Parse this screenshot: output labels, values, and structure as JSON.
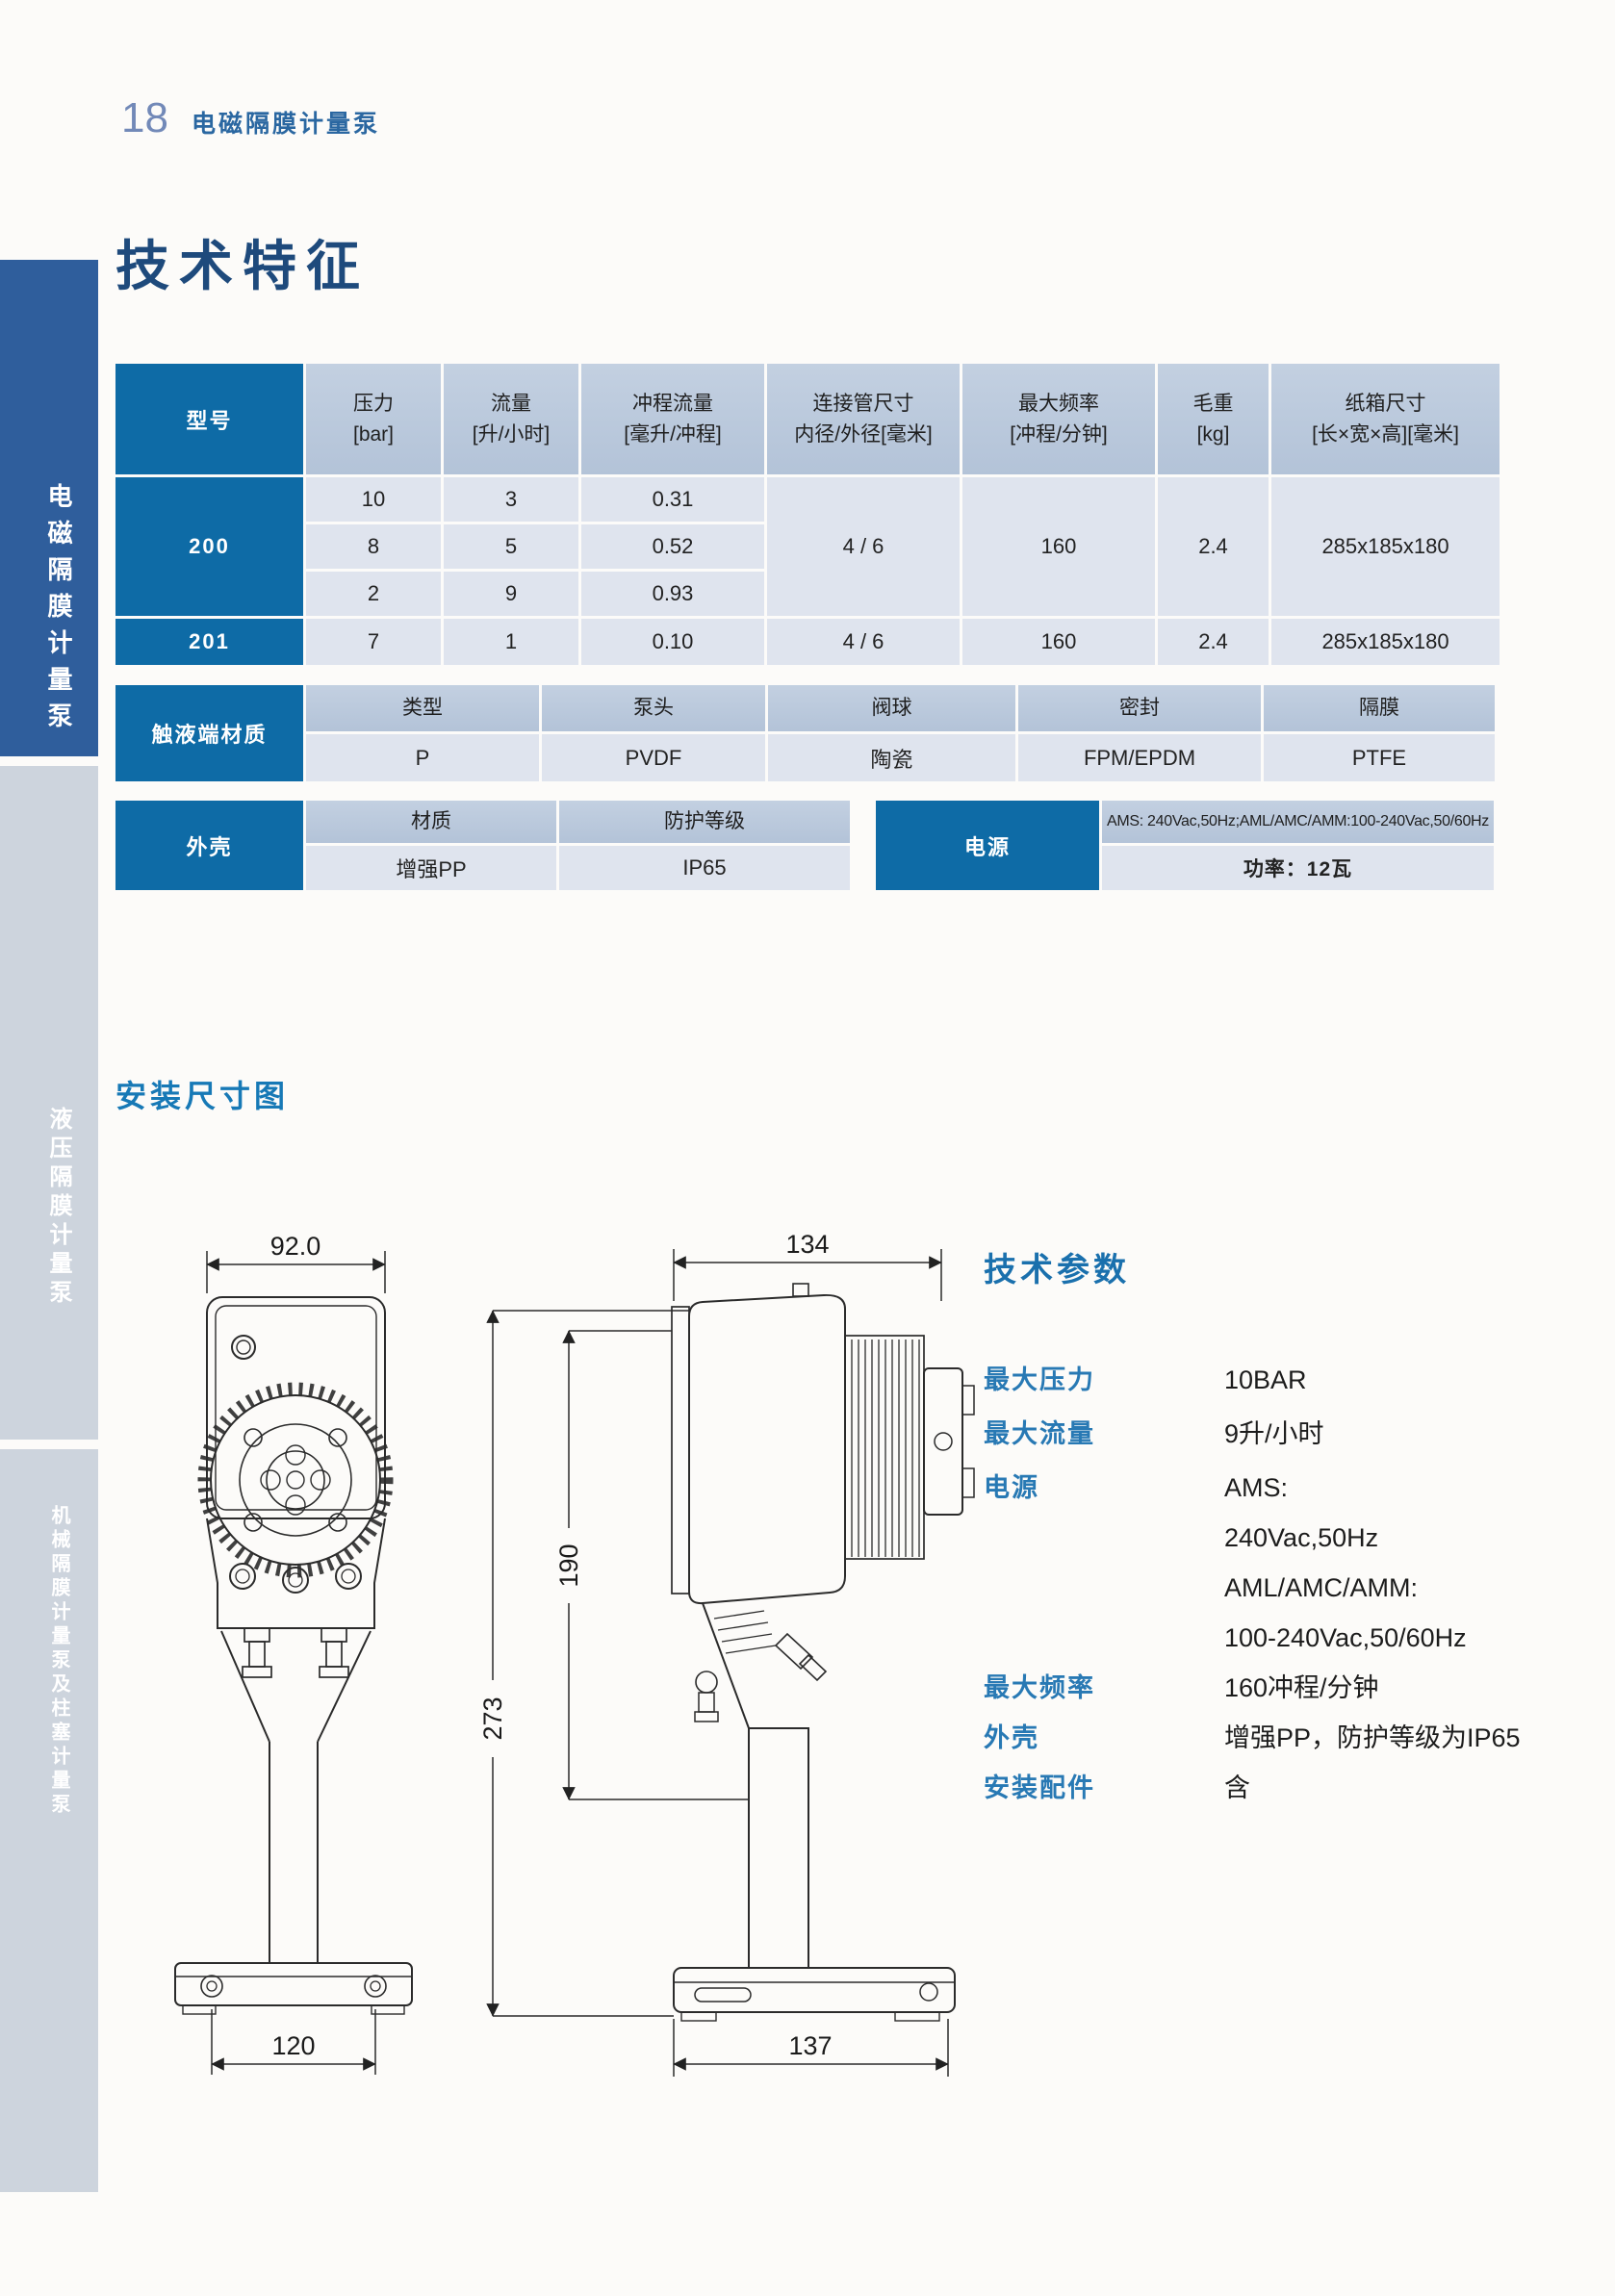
{
  "colors": {
    "table_label_blue": "#0e6ba6",
    "table_header_cell": "#b9c8db",
    "table_data_cell": "#dfe4ee",
    "sidebar_active_blue": "#2f5e9c",
    "sidebar_inactive_gray": "#cdd4dd",
    "heading_teal": "#1779b6",
    "title_navy": "#1e4a7c"
  },
  "header": {
    "page_number": "18",
    "section": "电磁隔膜计量泵"
  },
  "title": "技术特征",
  "sidebar": {
    "tabs": [
      {
        "label": "电磁隔膜计量泵",
        "active": true
      },
      {
        "label": "液压隔膜计量泵",
        "active": false
      },
      {
        "label": "机械隔膜计量泵及柱塞计量泵",
        "active": false
      }
    ]
  },
  "spec_table": {
    "col_headers": [
      {
        "line1": "型号",
        "line2": ""
      },
      {
        "line1": "压力",
        "line2": "[bar]"
      },
      {
        "line1": "流量",
        "line2": "[升/小时]"
      },
      {
        "line1": "冲程流量",
        "line2": "[毫升/冲程]"
      },
      {
        "line1": "连接管尺寸",
        "line2": "内径/外径[毫米]"
      },
      {
        "line1": "最大频率",
        "line2": "[冲程/分钟]"
      },
      {
        "line1": "毛重",
        "line2": "[kg]"
      },
      {
        "line1": "纸箱尺寸",
        "line2": "[长×宽×高][毫米]"
      }
    ],
    "model200": {
      "name": "200",
      "sub_rows": [
        {
          "pressure": "10",
          "flow": "3",
          "stroke": "0.31"
        },
        {
          "pressure": "8",
          "flow": "5",
          "stroke": "0.52"
        },
        {
          "pressure": "2",
          "flow": "9",
          "stroke": "0.93"
        }
      ],
      "pipe": "4 / 6",
      "freq": "160",
      "weight": "2.4",
      "carton": "285x185x180"
    },
    "model201": {
      "name": "201",
      "pressure": "7",
      "flow": "1",
      "stroke": "0.10",
      "pipe": "4 / 6",
      "freq": "160",
      "weight": "2.4",
      "carton": "285x185x180"
    }
  },
  "materials_table": {
    "label": "触液端材质",
    "headers": [
      "类型",
      "泵头",
      "阀球",
      "密封",
      "隔膜"
    ],
    "values": [
      "P",
      "PVDF",
      "陶瓷",
      "FPM/EPDM",
      "PTFE"
    ]
  },
  "housing_table": {
    "label": "外壳",
    "headers": [
      "材质",
      "防护等级"
    ],
    "values": [
      "增强PP",
      "IP65"
    ]
  },
  "power_table": {
    "label": "电源",
    "spec": "AMS: 240Vac,50Hz;AML/AMC/AMM:100-240Vac,50/60Hz",
    "power": "功率：12瓦"
  },
  "installation": {
    "title": "安装尺寸图",
    "dims": {
      "front_width": "92.0",
      "front_holes": "120",
      "side_top": "134",
      "side_mid_height": "190",
      "side_total_height": "273",
      "side_base": "137"
    }
  },
  "tech_params": {
    "title": "技术参数",
    "rows": [
      {
        "label": "最大压力",
        "value": "10BAR"
      },
      {
        "label": "最大流量",
        "value": "9升/小时"
      },
      {
        "label": "电源",
        "value": ""
      },
      {
        "label": "最大频率",
        "value": "160冲程/分钟"
      },
      {
        "label": "外壳",
        "value": "增强PP，防护等级为IP65"
      },
      {
        "label": "安装配件",
        "value": "含"
      }
    ],
    "power_lines": [
      "AMS:",
      "240Vac,50Hz",
      "AML/AMC/AMM:",
      "100-240Vac,50/60Hz"
    ]
  }
}
